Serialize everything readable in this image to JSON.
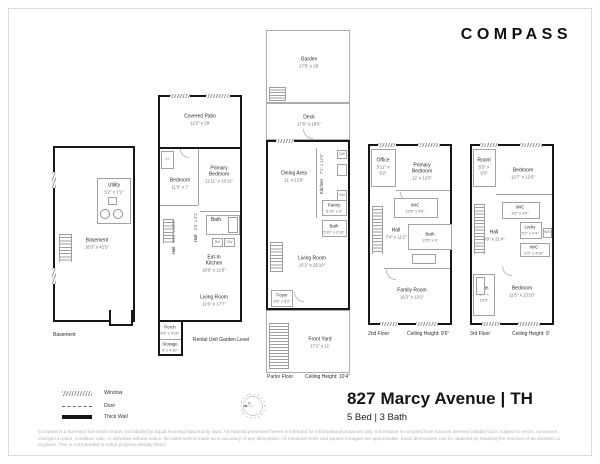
{
  "brand": {
    "logo": "COMPASS"
  },
  "title": {
    "address": "827 Marcy Avenue | TH",
    "beds_baths": "5 Bed | 3 Bath"
  },
  "legend": {
    "items": [
      {
        "label": "Window"
      },
      {
        "label": "Door"
      },
      {
        "label": "Thick Wall"
      }
    ]
  },
  "disclaimer": {
    "text": "Compass is a licensed real estate broker and abides by Equal Housing Opportunity laws. All material presented herein is intended for informational purposes only. Information is compiled from sources deemed reliable but is subject to errors, omissions, changes in price, condition, sale, or withdraw without notice. No statement is made as to accuracy of any description. All measurements and square footages are approximate. Exact dimensions can be obtained by retaining the services of an architect or engineer. This is not intended to solicit property already listed."
  },
  "colors": {
    "thick_wall": "#161616",
    "thin_line": "#a3a3a3",
    "room_text": "#2b2b2b",
    "dim_text": "#6e6e6e",
    "disclaimer_text": "#b3b3b3"
  },
  "floors": [
    {
      "label": "Basement",
      "ceiling": "",
      "rooms": [
        {
          "name": "Utility",
          "dims": "5'2\" x 7'1\""
        },
        {
          "name": "Basement",
          "dims": "18'3\" x 41'5\""
        }
      ]
    },
    {
      "label": "Rental Unit Garden Level",
      "ceiling": "",
      "rooms": [
        {
          "name": "Covered Patio",
          "dims": "12'2\" x 29'"
        },
        {
          "name": "Bedroom",
          "dims": "11'6\" x 7'"
        },
        {
          "name": "Primary Bedroom",
          "dims": "11'11\" x 10'11\""
        },
        {
          "name": "Hall",
          "dims": "5'11\" x 10'4\""
        },
        {
          "name": "Hall",
          "dims": "5'9\" x 3'1\""
        },
        {
          "name": "Bath",
          "dims": ""
        },
        {
          "name": "Eat-In Kitchen",
          "dims": "18'6\" x 11'6\""
        },
        {
          "name": "Living Room",
          "dims": "11'6\" x 17'7\""
        },
        {
          "name": "Porch",
          "dims": "4'4\" x 4'10\""
        },
        {
          "name": "Storage",
          "dims": "5' x 4'10\""
        }
      ],
      "fixtures": {
        "closet": "Cl.",
        "ref": "Ref",
        "dw": "DW"
      }
    },
    {
      "label": "Parlor Floor",
      "ceiling": "Ceiling Height: 10'4\"",
      "rooms": [
        {
          "name": "Garden",
          "dims": "17'5\" x 28'"
        },
        {
          "name": "Deck",
          "dims": "17'6\" x 18'5\""
        },
        {
          "name": "Dining Area",
          "dims": "11' x 12'8\""
        },
        {
          "name": "Kitchen",
          "dims": "7'1\" x 12'6\""
        },
        {
          "name": "Pantry",
          "dims": "5'10\" x 4'"
        },
        {
          "name": "Bath",
          "dims": "5'10\" x 3'10\""
        },
        {
          "name": "Living Room",
          "dims": "15'2\" x 25'10\""
        },
        {
          "name": "Foyer",
          "dims": "4'5\" x 5'2\""
        },
        {
          "name": "Front Yard",
          "dims": "17'2\" x 11'"
        }
      ],
      "fixtures": {
        "dw": "DW",
        "ref": "Ref"
      }
    },
    {
      "label": "2nd Floor",
      "ceiling": "Ceiling Height: 9'6\"",
      "rooms": [
        {
          "name": "Office",
          "dims": "5'11\" x 9'2\""
        },
        {
          "name": "Primary Bedroom",
          "dims": "12' x 12'5\""
        },
        {
          "name": "WIC",
          "dims": "10'5\" x 5'6\""
        },
        {
          "name": "Hall",
          "dims": "7'4\" x 11'2\""
        },
        {
          "name": "Bath",
          "dims": "10'5\" x 9'"
        },
        {
          "name": "Family Room",
          "dims": "16'2\" x 13'2\""
        }
      ]
    },
    {
      "label": "3rd Floor",
      "ceiling": "Ceiling Height: 9'",
      "rooms": [
        {
          "name": "Room",
          "dims": "5'5\" x 9'3\""
        },
        {
          "name": "Bedroom",
          "dims": "12'7\" x 12'5\""
        },
        {
          "name": "WIC",
          "dims": "8'2\" x 4'5\""
        },
        {
          "name": "Hall",
          "dims": "9'9\" x 21'4\""
        },
        {
          "name": "Lndry",
          "dims": "5'2\" x 4'4\""
        },
        {
          "name": "WIC",
          "dims": "6'2\" x 4'10\""
        },
        {
          "name": "Bath",
          "dims": "6'4\" x 10'5\""
        },
        {
          "name": "Bedroom",
          "dims": "11'5\" x 13'10\""
        }
      ],
      "fixtures": {
        "wd": "W/D"
      }
    }
  ]
}
